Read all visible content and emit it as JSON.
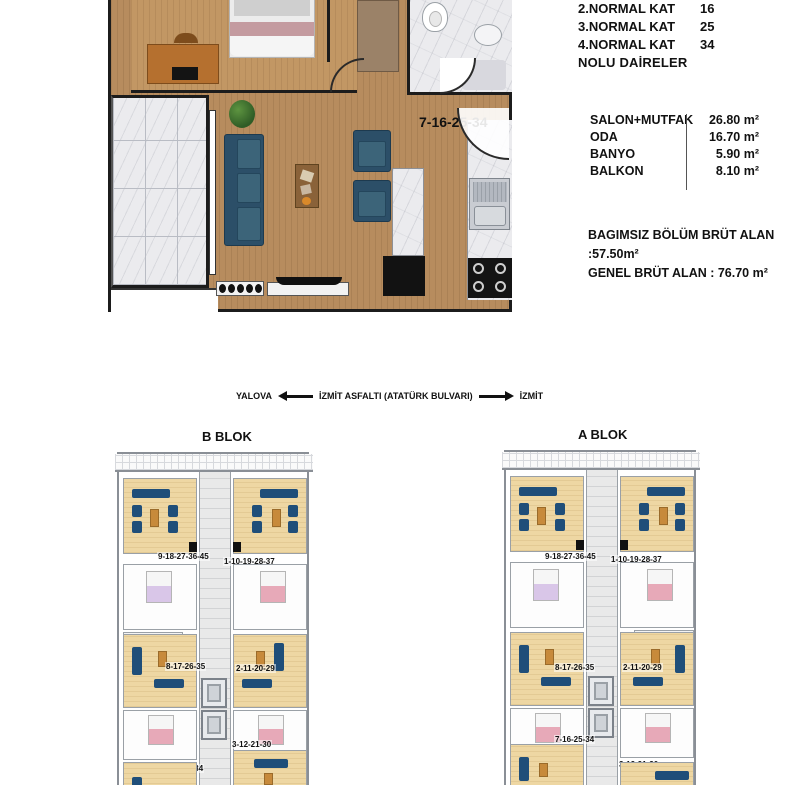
{
  "info": {
    "floors": [
      {
        "label": "2.NORMAL KAT",
        "value": "16"
      },
      {
        "label": "3.NORMAL KAT",
        "value": "25"
      },
      {
        "label": "4.NORMAL KAT",
        "value": "34"
      }
    ],
    "nolu": "NOLU  DAİRELER",
    "areas": [
      {
        "label": "SALON+MUTFAK",
        "value": "26.80 m²"
      },
      {
        "label": "ODA",
        "value": "16.70 m²"
      },
      {
        "label": "BANYO",
        "value": "5.90 m²"
      },
      {
        "label": "BALKON",
        "value": "8.10 m²"
      }
    ],
    "gross_line1": "BAGIMSIZ  BÖLÜM BRÜT ALAN :57.50m²",
    "gross_line2": "GENEL BRÜT ALAN : 76.70 m²"
  },
  "main_plan": {
    "unit_label": "7-16-25-34"
  },
  "road": {
    "left_city": "YALOVA",
    "road_name": "İZMİT ASFALTI  (ATATÜRK  BULVARI)",
    "right_city": "İZMİT"
  },
  "blocks": {
    "b": {
      "title": "B BLOK",
      "units": [
        "9-18-27-36-45",
        "1-10-19-28-37",
        "8-17-26-35",
        "2-11-20-29",
        "3-12-21-30",
        "7-16-25-34"
      ]
    },
    "a": {
      "title": "A BLOK",
      "units": [
        "9-18-27-36-45",
        "1-10-19-28-37",
        "8-17-26-35",
        "2-11-20-29",
        "7-16-25-34",
        "3-12-21-30"
      ]
    }
  },
  "colors": {
    "wood_floor": "#b78c5e",
    "cream_floor": "#eed7a3",
    "sofa_navy": "#2c4f68",
    "marble": "#ebebee",
    "bed_pink": "#e7a9b8",
    "wall_black": "#1c1c1c",
    "building_wall": "#8a8f96"
  }
}
